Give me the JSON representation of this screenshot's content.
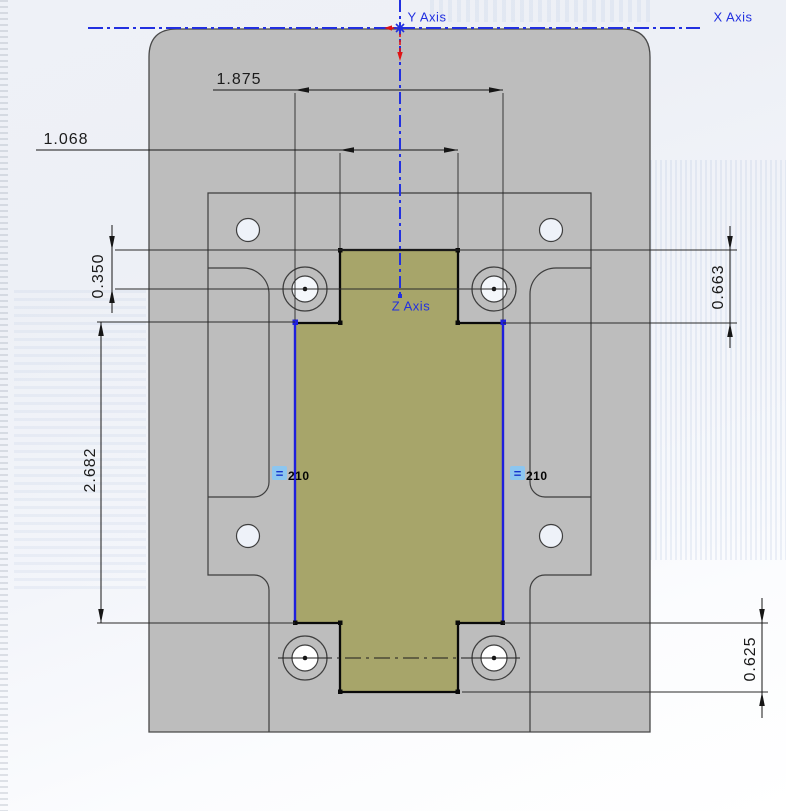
{
  "view": {
    "type": "cad-sketch-viewport"
  },
  "axes": {
    "x": "X Axis",
    "y": "Y Axis",
    "z": "Z Axis",
    "color": "#2230e0"
  },
  "dims": {
    "width_outer": "1.875",
    "width_notch": "1.068",
    "top_hole_offset": "0.350",
    "top_step": "0.663",
    "side_length": "2.682",
    "bottom_step": "0.625"
  },
  "relations": {
    "left": {
      "glyph": "=",
      "id": "210"
    },
    "right": {
      "glyph": "=",
      "id": "210"
    }
  },
  "colors": {
    "part_fill": "#bdbdbd",
    "sketch_fill": "#a7a56a",
    "sketch_blue": "#1f1fdd",
    "edge": "#3e3e3e",
    "dimension": "#161616",
    "relation_badge": "#8cc6f0",
    "origin_red": "#e01414"
  }
}
